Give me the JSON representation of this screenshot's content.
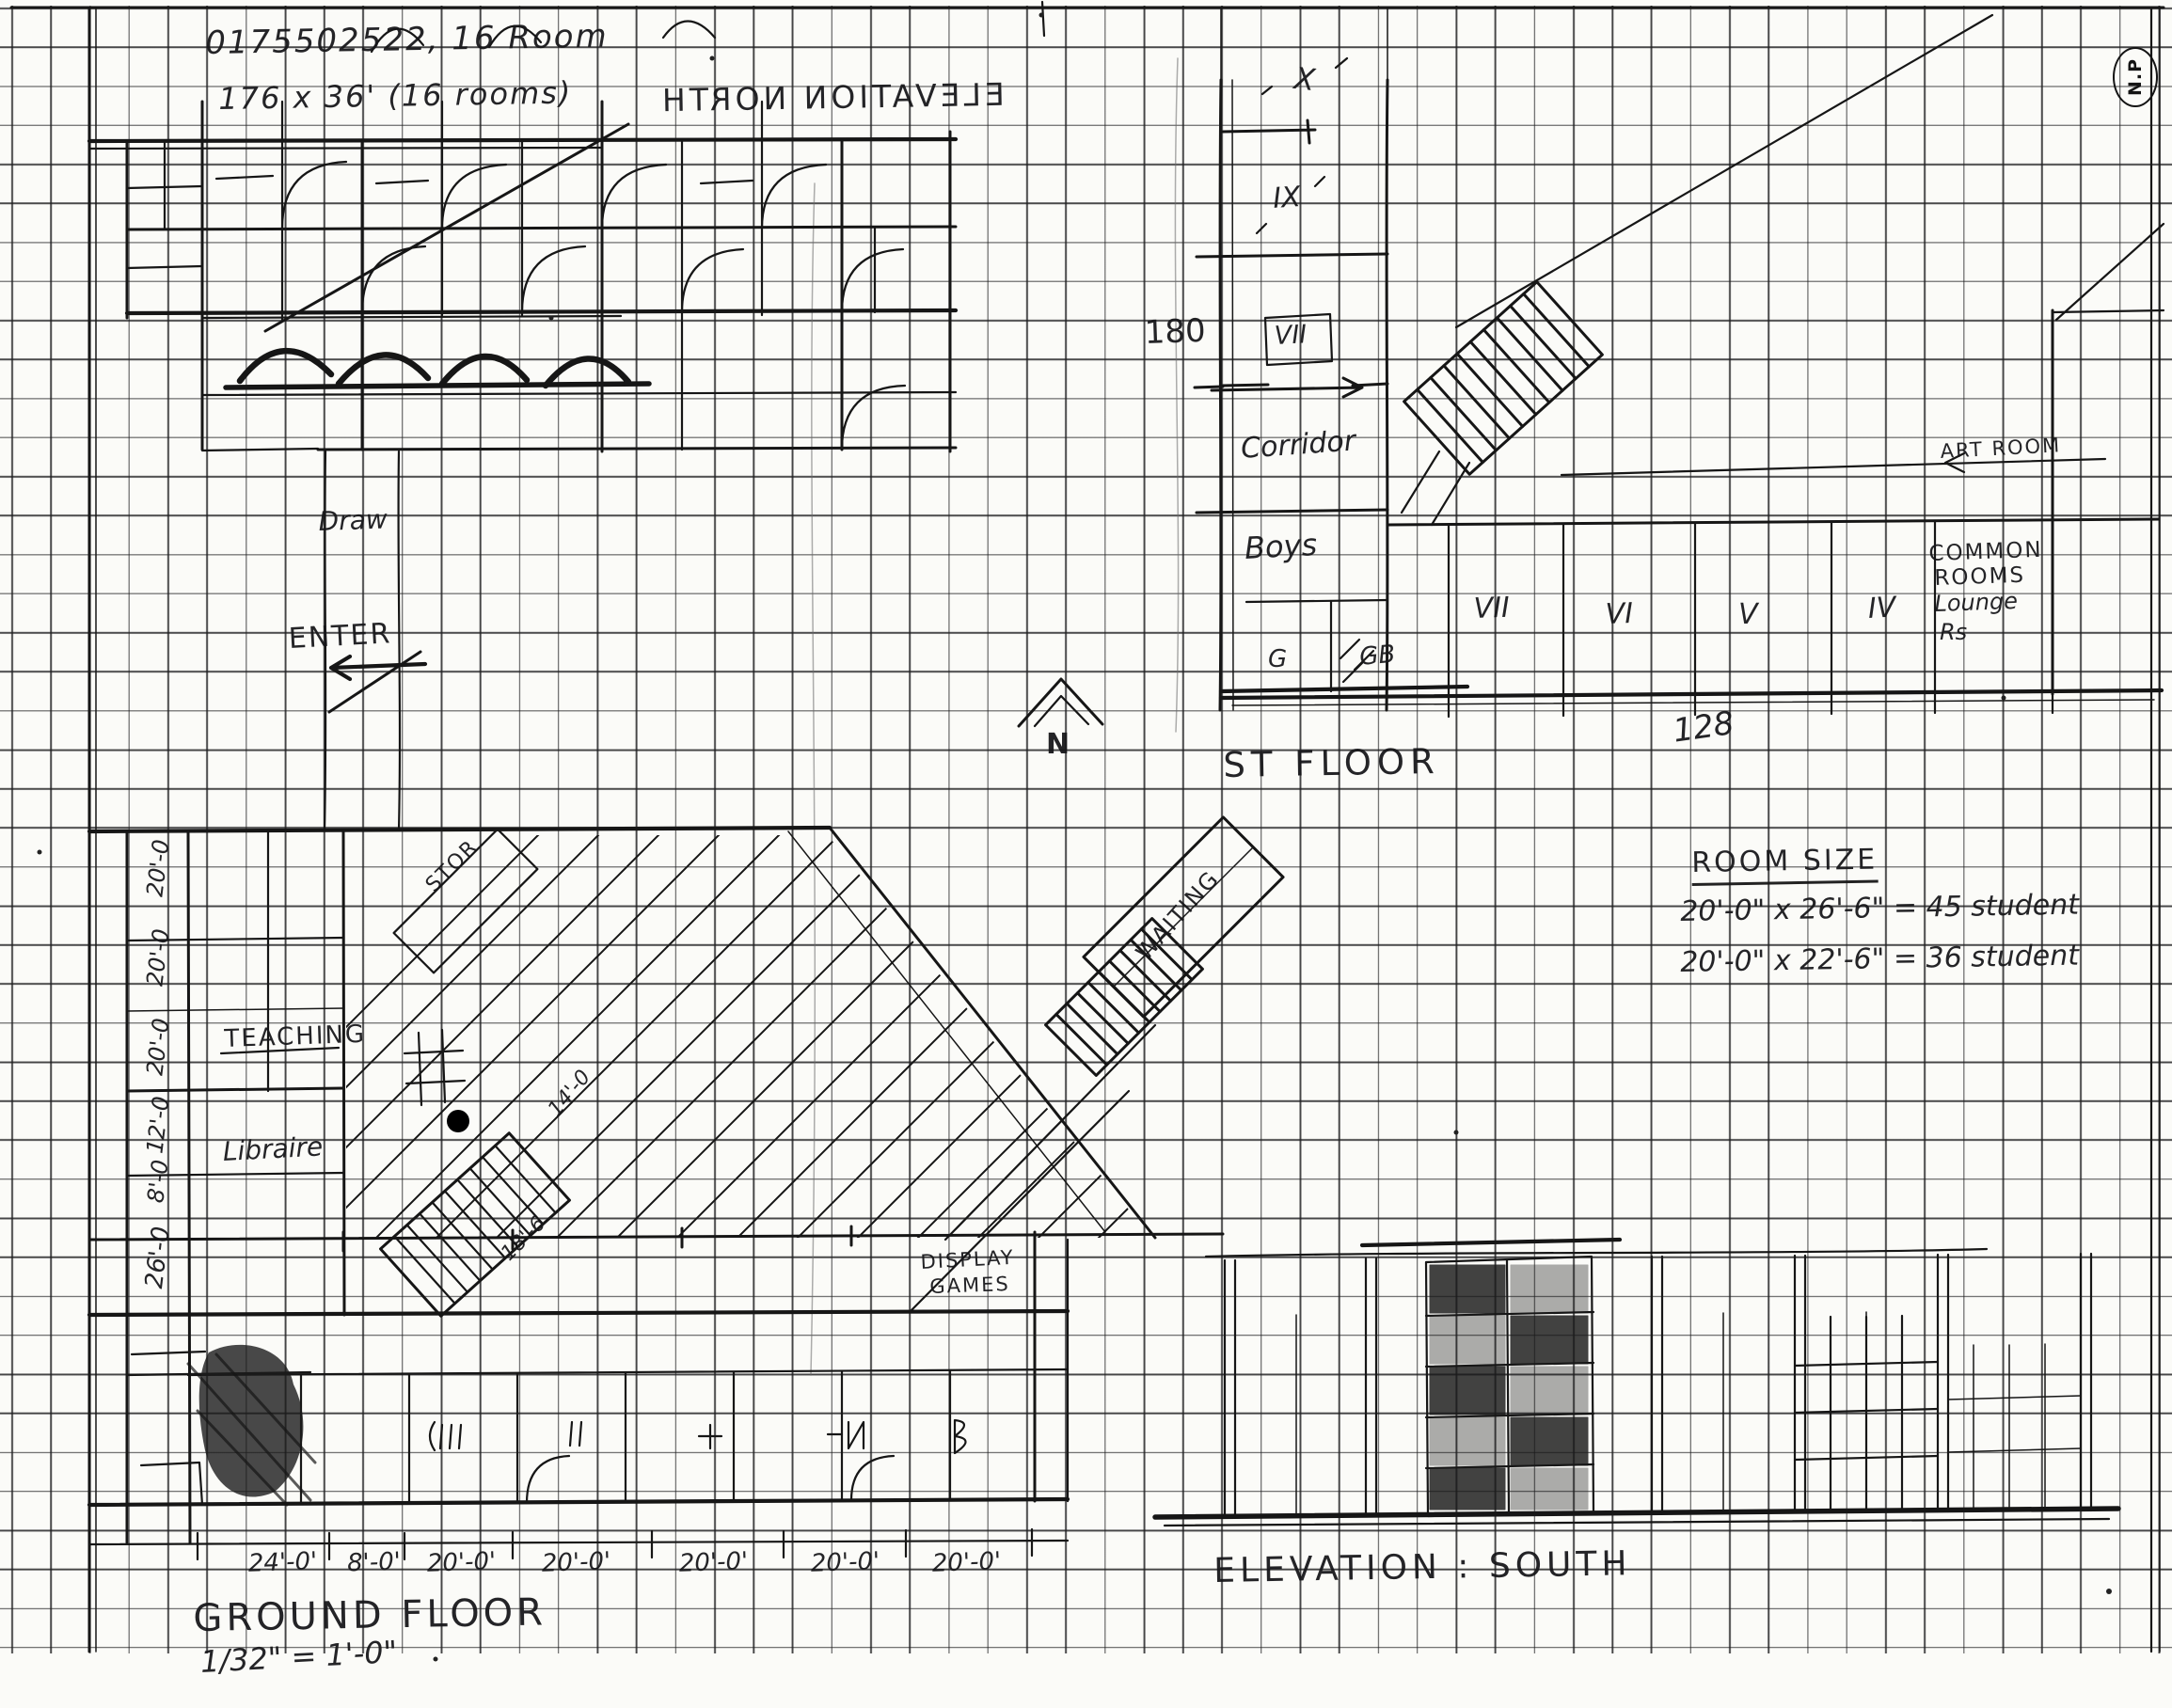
{
  "header": {
    "ref_number": "0175502522, 16 Room",
    "dimensions_note": "176 x 36' (16 rooms)",
    "mirrored_title": "ELEVATION NORTH",
    "initials": "N.P"
  },
  "first_floor": {
    "label": "ST FLOOR",
    "room_x": "X",
    "room_ix": "IX",
    "room_vii_wing": "VII",
    "room_vii": "VII",
    "room_vi": "VI",
    "room_v": "V",
    "room_iv": "IV",
    "corridor": "Corridor",
    "boys": "Boys",
    "g": "G",
    "gb": "GB",
    "art_room": "ART ROOM",
    "common_room": {
      "l1": "COMMON",
      "l2": "ROOMS",
      "l3": "Lounge",
      "l4": "Rs"
    },
    "dim_180": "180",
    "area_128": "128"
  },
  "north_arrow": {
    "label": "N"
  },
  "room_size": {
    "heading": "ROOM SIZE",
    "line1": "20'-0\" x 26'-6\" = 45 student",
    "line2": "20'-0\" x 22'-6\" = 36 student"
  },
  "ground_floor": {
    "label": "GROUND FLOOR",
    "scale": "1/32\" = 1'-0\"",
    "draw": "Draw",
    "enter": "ENTER",
    "stor": "STOR",
    "waiting": "WAITING",
    "teaching": "TEACHING",
    "library": "Libraire",
    "display_line1": "DISPLAY",
    "display_line2": "GAMES",
    "stair_dim1": "14'-0",
    "stair_dim2": "18'-6",
    "left_dims": [
      "20'-0",
      "20'-0",
      "20'-0",
      "12'-0",
      "8'-0",
      "26'-0"
    ],
    "bottom_dims": [
      "24'-0'",
      "8'-0'",
      "20'-0'",
      "20'-0'",
      "20'-0'",
      "20'-0'",
      "20'-0'"
    ]
  },
  "south_elevation": {
    "label": "ELEVATION : SOUTH"
  },
  "colors": {
    "ink": "#161616",
    "paper": "#fbfbf8"
  }
}
